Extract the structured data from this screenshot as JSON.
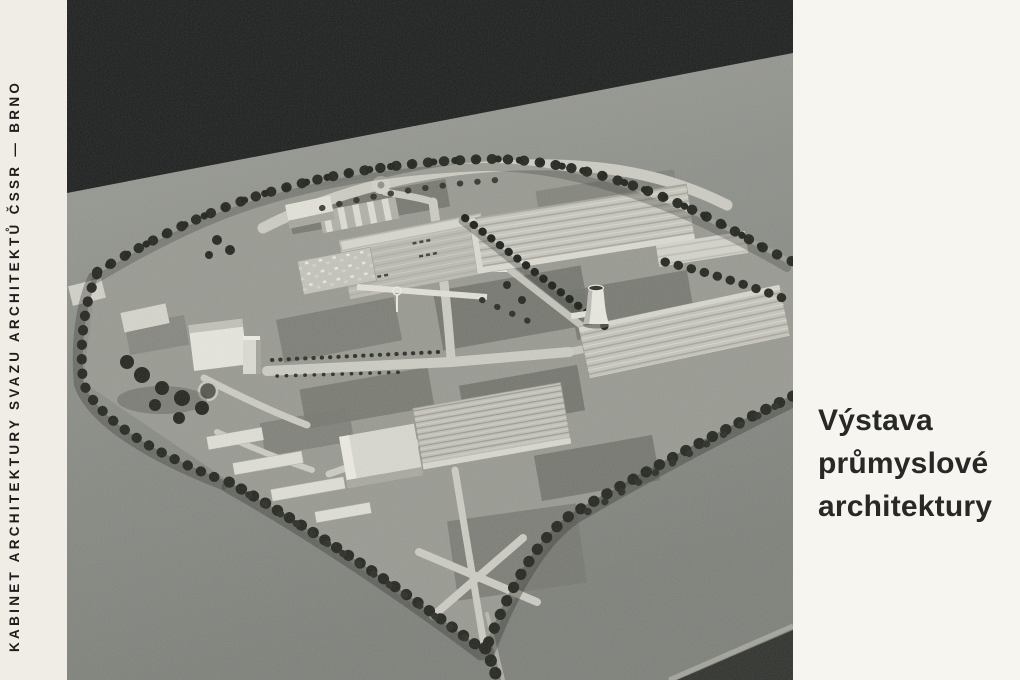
{
  "cover": {
    "spine": {
      "text": "KABINET ARCHITEKTURY SVAZU ARCHITEKTŮ ČSSR — BRNO"
    },
    "title": {
      "lines": [
        "Výstava",
        "průmyslové",
        "architektury"
      ]
    },
    "photo": {
      "subject": "aerial-photograph-of-architectural-scale-model-of-industrial-complex",
      "features": [
        "factory-halls-with-ridged-roofs",
        "cooling-tower",
        "tree-lined-boundary-roads",
        "central-office-buildings",
        "entrance-plaza"
      ]
    }
  },
  "palette": {
    "paper_spine": "#efede6",
    "paper_panel": "#f6f5f0",
    "ink": "#1d1d1b",
    "title_ink": "#282826",
    "photo_backdrop_black": "#1d1f1e",
    "table_grey": "#8e908a",
    "site_grey": "#999a92",
    "lawn_grey": "#72746c",
    "building_light": "#dddcd3",
    "road_light": "#cdccc3",
    "tree_dark": "#24261f"
  }
}
